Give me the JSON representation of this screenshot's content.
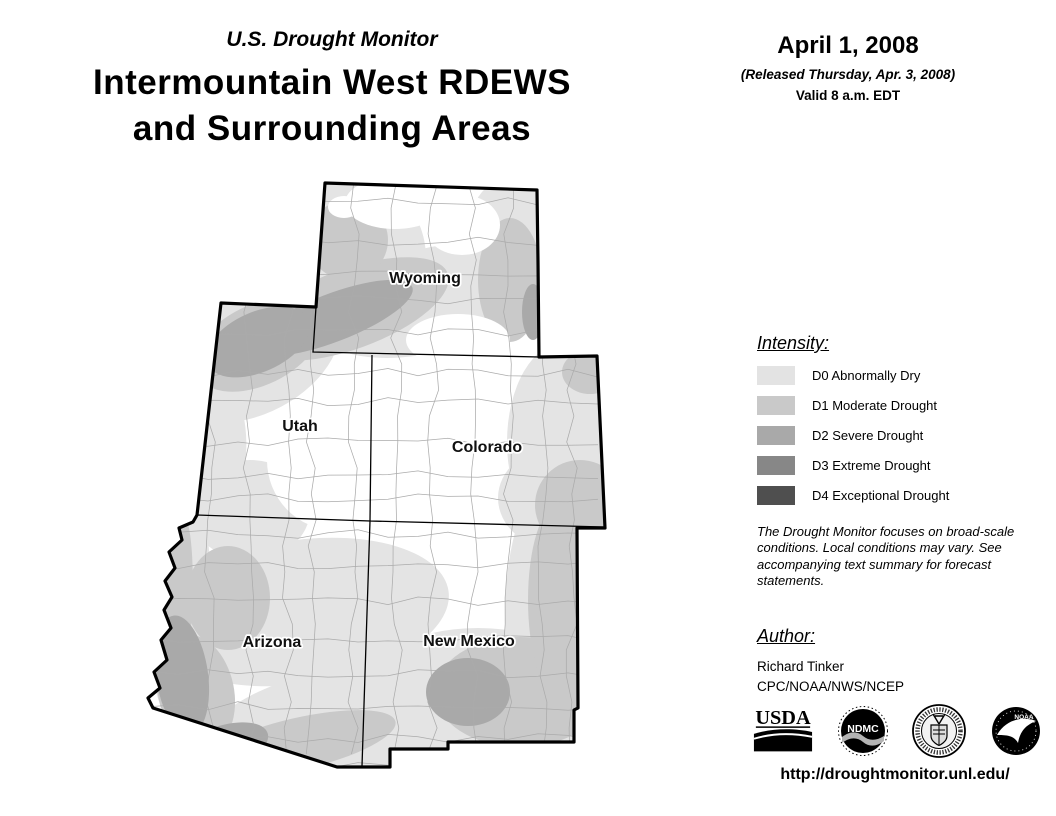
{
  "header": {
    "kicker": "U.S. Drought Monitor",
    "title": "Intermountain West RDEWS and Surrounding Areas",
    "title_line1": "Intermountain West RDEWS",
    "title_line2": "and Surrounding Areas"
  },
  "date_block": {
    "date": "April 1, 2008",
    "released": "(Released Thursday, Apr. 3, 2008)",
    "valid": "Valid 8 a.m. EDT"
  },
  "legend": {
    "heading": "Intensity:",
    "items": [
      {
        "code": "D0",
        "label": "D0 Abnormally Dry",
        "color": "#e3e3e3"
      },
      {
        "code": "D1",
        "label": "D1 Moderate Drought",
        "color": "#c9c9c9"
      },
      {
        "code": "D2",
        "label": "D2 Severe Drought",
        "color": "#a9a9a9"
      },
      {
        "code": "D3",
        "label": "D3 Extreme Drought",
        "color": "#878787"
      },
      {
        "code": "D4",
        "label": "D4 Exceptional Drought",
        "color": "#4f4f4f"
      }
    ]
  },
  "disclaimer": "The Drought Monitor focuses on broad-scale conditions. Local conditions may vary. See accompanying text summary for forecast statements.",
  "author": {
    "heading": "Author:",
    "name": "Richard Tinker",
    "org": "CPC/NOAA/NWS/NCEP"
  },
  "logos": [
    {
      "name": "usda-logo",
      "text": "USDA"
    },
    {
      "name": "ndmc-logo",
      "text": "NDMC"
    },
    {
      "name": "commerce-seal-logo",
      "text": ""
    },
    {
      "name": "noaa-logo",
      "text": "NOAA"
    }
  ],
  "url": "http://droughtmonitor.unl.edu/",
  "map": {
    "palette": {
      "d0": "#e4e4e4",
      "d1": "#c9c9c9",
      "d2": "#a9a9a9",
      "none": "#ffffff"
    },
    "outline": "M325,183 L537,190 L538,262 L539,357 L597,356 L605,528 L577,528 L578,708 L574,710 L574,742 L448,742 L448,749 L390,749 L390,767 L337,767 L153,708 L148,698 L160,688 L154,672 L167,660 L161,640 L171,628 L164,610 L172,597 L165,581 L175,568 L169,552 L182,540 L179,528 L193,522 L197,515 L221,303 L316,307 Z",
    "internal_borders": [
      "M316,307 L313,352 L539,357",
      "M372,355 L370,521 L605,527",
      "M197,515 L370,521 L362,766"
    ],
    "regions": [
      {
        "level": "d0",
        "cx": 338,
        "cy": 258,
        "rx": 88,
        "ry": 88,
        "rot": 0
      },
      {
        "level": "d0",
        "cx": 432,
        "cy": 300,
        "rx": 118,
        "ry": 52,
        "rot": -14
      },
      {
        "level": "d0",
        "cx": 515,
        "cy": 250,
        "rx": 52,
        "ry": 75,
        "rot": 0
      },
      {
        "level": "d0",
        "cx": 252,
        "cy": 352,
        "rx": 95,
        "ry": 62,
        "rot": -28
      },
      {
        "level": "d0",
        "cx": 214,
        "cy": 455,
        "rx": 32,
        "ry": 75,
        "rot": 4
      },
      {
        "level": "d0",
        "cx": 250,
        "cy": 510,
        "rx": 60,
        "ry": 50,
        "rot": 0
      },
      {
        "level": "d0",
        "cx": 300,
        "cy": 612,
        "rx": 150,
        "ry": 72,
        "rot": -8
      },
      {
        "level": "d0",
        "cx": 180,
        "cy": 605,
        "rx": 30,
        "ry": 115,
        "rot": 3
      },
      {
        "level": "d0",
        "cx": 330,
        "cy": 733,
        "rx": 135,
        "ry": 62,
        "rot": -12
      },
      {
        "level": "d0",
        "cx": 478,
        "cy": 700,
        "rx": 125,
        "ry": 72,
        "rot": 0
      },
      {
        "level": "d0",
        "cx": 553,
        "cy": 615,
        "rx": 48,
        "ry": 135,
        "rot": 0
      },
      {
        "level": "d0",
        "cx": 560,
        "cy": 498,
        "rx": 62,
        "ry": 52,
        "rot": 0
      },
      {
        "level": "d0",
        "cx": 565,
        "cy": 442,
        "rx": 58,
        "ry": 100,
        "rot": 0
      },
      {
        "level": "d1",
        "cx": 350,
        "cy": 309,
        "rx": 104,
        "ry": 40,
        "rot": -20
      },
      {
        "level": "d1",
        "cx": 348,
        "cy": 240,
        "rx": 40,
        "ry": 40,
        "rot": 0
      },
      {
        "level": "d1",
        "cx": 510,
        "cy": 280,
        "rx": 32,
        "ry": 62,
        "rot": 0
      },
      {
        "level": "d1",
        "cx": 258,
        "cy": 345,
        "rx": 68,
        "ry": 40,
        "rot": -26
      },
      {
        "level": "d1",
        "cx": 228,
        "cy": 598,
        "rx": 42,
        "ry": 52,
        "rot": 0
      },
      {
        "level": "d1",
        "cx": 176,
        "cy": 612,
        "rx": 16,
        "ry": 100,
        "rot": 3
      },
      {
        "level": "d1",
        "cx": 196,
        "cy": 692,
        "rx": 38,
        "ry": 58,
        "rot": -12
      },
      {
        "level": "d1",
        "cx": 298,
        "cy": 744,
        "rx": 100,
        "ry": 26,
        "rot": -13
      },
      {
        "level": "d1",
        "cx": 520,
        "cy": 692,
        "rx": 85,
        "ry": 55,
        "rot": 0
      },
      {
        "level": "d1",
        "cx": 558,
        "cy": 600,
        "rx": 30,
        "ry": 95,
        "rot": 0
      },
      {
        "level": "d1",
        "cx": 580,
        "cy": 505,
        "rx": 45,
        "ry": 45,
        "rot": 0
      },
      {
        "level": "d1",
        "cx": 590,
        "cy": 372,
        "rx": 28,
        "ry": 22,
        "rot": 0
      },
      {
        "level": "d2",
        "cx": 332,
        "cy": 318,
        "rx": 86,
        "ry": 24,
        "rot": -21
      },
      {
        "level": "d2",
        "cx": 258,
        "cy": 342,
        "rx": 55,
        "ry": 30,
        "rot": -24
      },
      {
        "level": "d2",
        "cx": 533,
        "cy": 312,
        "rx": 11,
        "ry": 28,
        "rot": 0
      },
      {
        "level": "d2",
        "cx": 182,
        "cy": 675,
        "rx": 26,
        "ry": 60,
        "rot": -8
      },
      {
        "level": "d2",
        "cx": 222,
        "cy": 748,
        "rx": 48,
        "ry": 22,
        "rot": -18
      },
      {
        "level": "d2",
        "cx": 468,
        "cy": 692,
        "rx": 42,
        "ry": 34,
        "rot": 0
      },
      {
        "level": "none",
        "cx": 395,
        "cy": 203,
        "rx": 50,
        "ry": 26,
        "rot": 0
      },
      {
        "level": "none",
        "cx": 462,
        "cy": 225,
        "rx": 38,
        "ry": 30,
        "rot": 0
      },
      {
        "level": "none",
        "cx": 458,
        "cy": 340,
        "rx": 52,
        "ry": 26,
        "rot": 0
      },
      {
        "level": "none",
        "cx": 344,
        "cy": 207,
        "rx": 16,
        "ry": 11,
        "rot": 0
      },
      {
        "level": "none",
        "cx": 335,
        "cy": 460,
        "rx": 68,
        "ry": 70,
        "rot": 0
      }
    ],
    "counties": {
      "seed": 42,
      "color": "#ababab",
      "width": 0.75,
      "x_start": 208,
      "x_end": 600,
      "x_step": 37,
      "y_start": 206,
      "y_end": 770,
      "y_step": 33,
      "y_min": 182,
      "y_max": 774,
      "x_min": 148,
      "x_max": 612
    },
    "states": [
      {
        "label": "Wyoming",
        "x": 425,
        "y": 283
      },
      {
        "label": "Utah",
        "x": 300,
        "y": 431
      },
      {
        "label": "Colorado",
        "x": 487,
        "y": 452
      },
      {
        "label": "Arizona",
        "x": 272,
        "y": 647
      },
      {
        "label": "New Mexico",
        "x": 469,
        "y": 646
      }
    ]
  }
}
